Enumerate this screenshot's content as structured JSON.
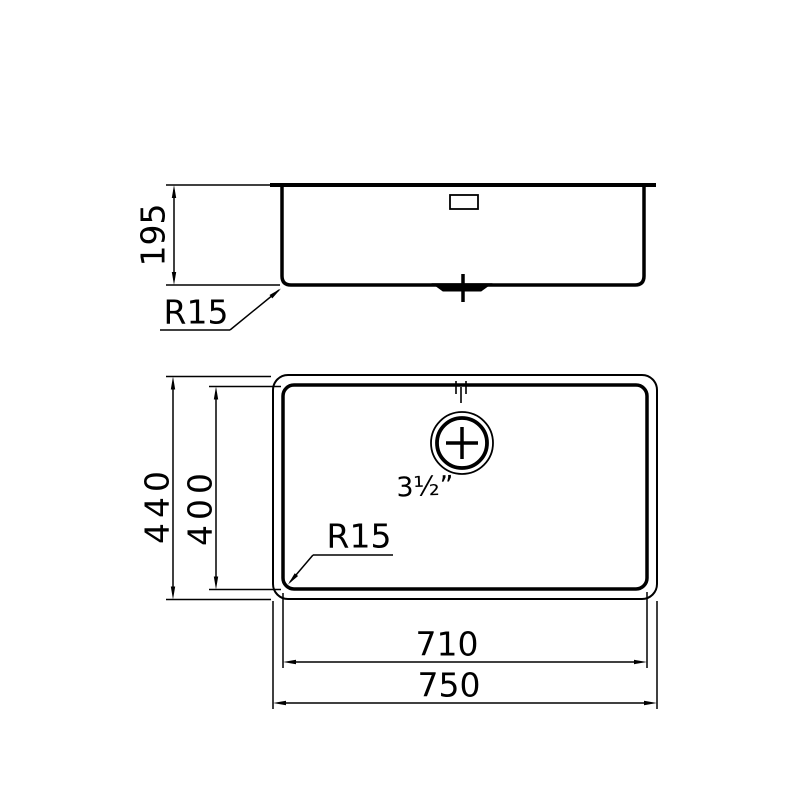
{
  "drawing": {
    "side_view": {
      "height_label": "195",
      "corner_radius_label": "R15"
    },
    "plan_view": {
      "overall_width_label": "750",
      "bowl_width_label": "710",
      "overall_depth_label": "440",
      "bowl_depth_label": "400",
      "corner_radius_label": "R15",
      "drain_size_label": "3½”"
    },
    "colors": {
      "line": "#000000",
      "background": "#ffffff"
    }
  }
}
